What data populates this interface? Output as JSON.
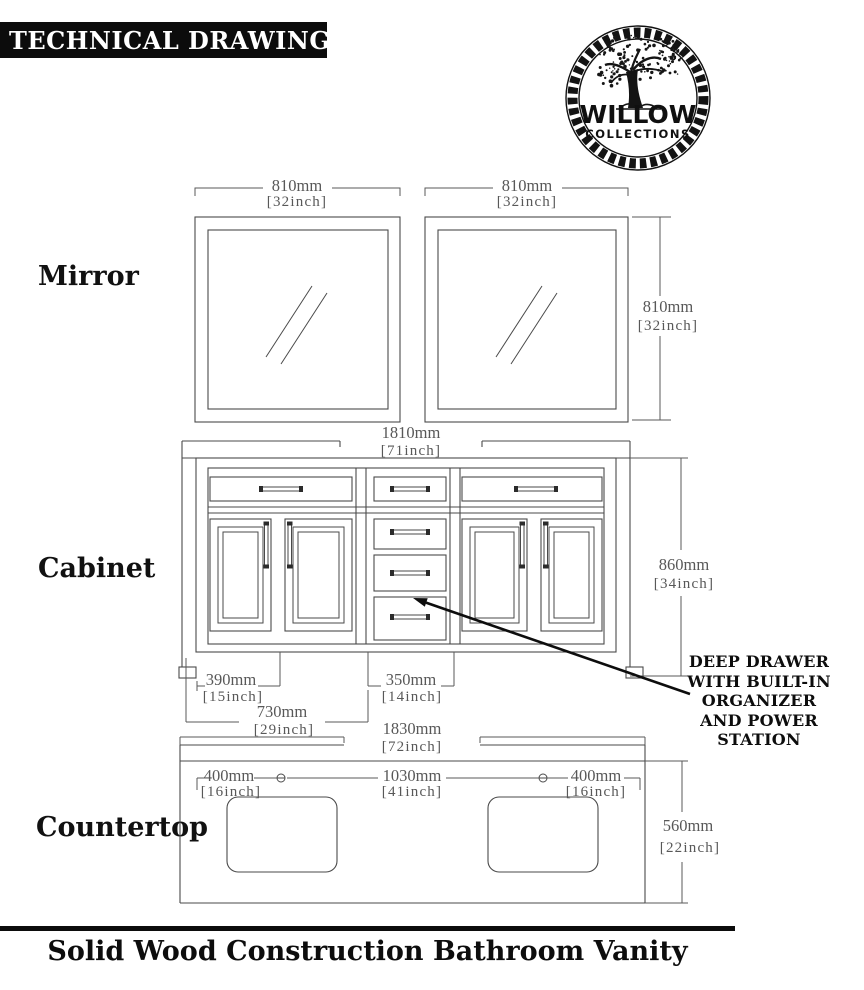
{
  "header": {
    "title": "TECHNICAL DRAWING"
  },
  "logo": {
    "brand": "WILLOW",
    "sub": "COLLECTIONS"
  },
  "sections": {
    "mirror": "Mirror",
    "cabinet": "Cabinet",
    "countertop": "Countertop"
  },
  "dimensions": {
    "mirror_width_left": {
      "mm": "810mm",
      "inch": "[32inch]"
    },
    "mirror_width_right": {
      "mm": "810mm",
      "inch": "[32inch]"
    },
    "mirror_height": {
      "mm": "810mm",
      "inch": "[32inch]"
    },
    "cabinet_width": {
      "mm": "1810mm",
      "inch": "[71inch]"
    },
    "cabinet_height": {
      "mm": "860mm",
      "inch": "[34inch]"
    },
    "cabinet_left": {
      "mm": "390mm",
      "inch": "[15inch]"
    },
    "cabinet_middle": {
      "mm": "350mm",
      "inch": "[14inch]"
    },
    "cabinet_left_total": {
      "mm": "730mm",
      "inch": "[29inch]"
    },
    "countertop_width": {
      "mm": "1830mm",
      "inch": "[72inch]"
    },
    "countertop_left": {
      "mm": "400mm",
      "inch": "[16inch]"
    },
    "countertop_center": {
      "mm": "1030mm",
      "inch": "[41inch]"
    },
    "countertop_right": {
      "mm": "400mm",
      "inch": "[16inch]"
    },
    "countertop_depth": {
      "mm": "560mm",
      "inch": "[22inch]"
    }
  },
  "annotation": {
    "line1": "DEEP DRAWER",
    "line2": "WITH BUILT-IN",
    "line3": "ORGANIZER",
    "line4": "AND POWER STATION"
  },
  "footer": {
    "title": "Solid Wood Construction Bathroom Vanity"
  },
  "colors": {
    "line": "#4a4a4a",
    "dim_text": "#585858",
    "text": "#0d0d0d",
    "header_bg": "#0c0c0c"
  }
}
